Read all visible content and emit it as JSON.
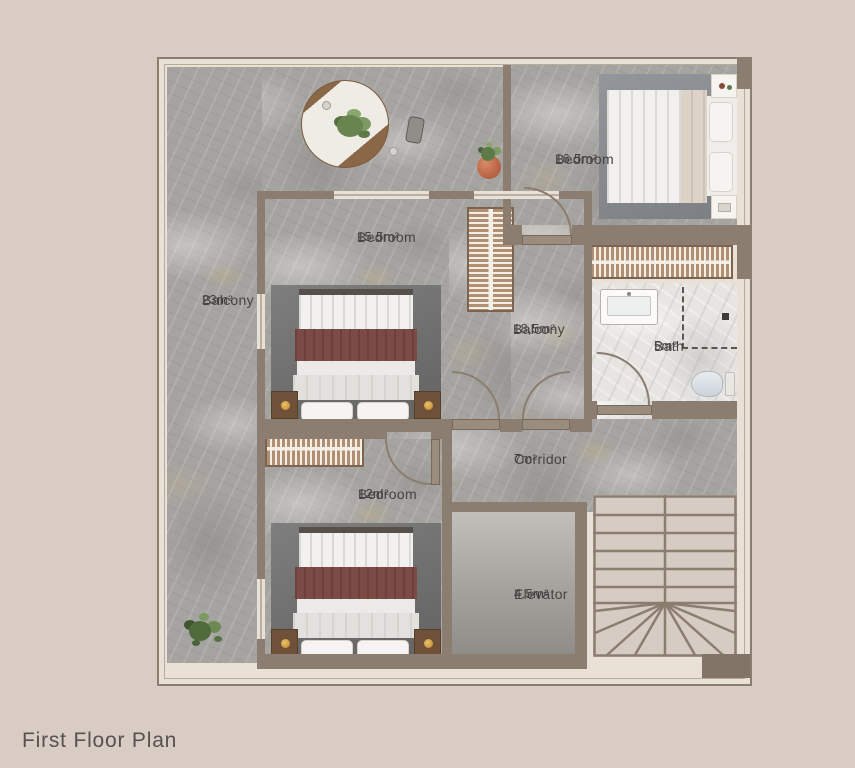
{
  "title": "First Floor Plan",
  "rooms": {
    "balcony_large": {
      "label": "Balcony",
      "area": "23m²"
    },
    "bedroom_top": {
      "label": "Bedroom",
      "area": "16.5m²"
    },
    "bedroom_mid": {
      "label": "Bedroom",
      "area": "15.5m²"
    },
    "balcony_mid": {
      "label": "Balcony",
      "area": "18,5m²"
    },
    "bath": {
      "label": "Bath",
      "area": "5m²"
    },
    "corridor": {
      "label": "Corridor",
      "area": "7m²"
    },
    "bedroom_bottom": {
      "label": "Bedroom",
      "area": "12m²"
    },
    "elevator": {
      "label": "Elevator",
      "area": "4.5m²"
    }
  },
  "palette": {
    "background": "#d8ccc5",
    "wall": "#8b7d6f",
    "floor_gray_marble": "#a6a4a1",
    "floor_white_marble": "#e7e5e2",
    "accent_blanket": "#7d4b45",
    "label_text": "#454341"
  },
  "furniture": [
    "dining-table",
    "chair",
    "potted-plant",
    "double-bed",
    "nightstand",
    "wardrobe",
    "sink",
    "shower",
    "toilet",
    "staircase",
    "elevator-cab",
    "plant"
  ]
}
